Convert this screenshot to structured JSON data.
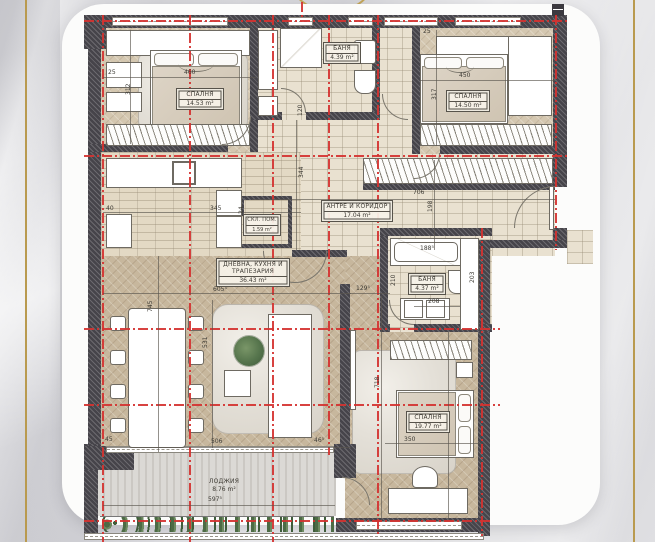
{
  "plan": {
    "title": "apartment-floor-plan",
    "colors": {
      "axis_red": "#d43230",
      "gold_trim": "#b99a4f",
      "wall": "#46444a",
      "wood_floor": "#c7b79d",
      "tile_floor": "#e9e1d0"
    },
    "rooms": [
      {
        "id": "bedroom-1",
        "name": "СПАЛНЯ",
        "area": "14.53 m²"
      },
      {
        "id": "bath-1",
        "name": "БАНЯ",
        "area": "4.39 m²"
      },
      {
        "id": "bedroom-2",
        "name": "СПАЛНЯ",
        "area": "14.50 m²"
      },
      {
        "id": "hall",
        "name": "АНТРЕ И КОРИДОР",
        "area": "17.04 m²"
      },
      {
        "id": "storage",
        "name": "СКЛ. ПОМ.",
        "area": "1.59 m²"
      },
      {
        "id": "living",
        "name": "ДНЕВНА, КУХНЯ И ТРАПЕЗАРИЯ",
        "area": "36.43 m²"
      },
      {
        "id": "bath-2",
        "name": "БАНЯ",
        "area": "4.37 m²"
      },
      {
        "id": "bedroom-3",
        "name": "СПАЛНЯ",
        "area": "19.77 m²"
      },
      {
        "id": "loggia",
        "name": "ЛОДЖИЯ",
        "area": "8.76 m²"
      }
    ],
    "dims": [
      {
        "t": "460"
      },
      {
        "t": "312"
      },
      {
        "t": "25"
      },
      {
        "t": "450"
      },
      {
        "t": "317"
      },
      {
        "t": "25"
      },
      {
        "t": "344"
      },
      {
        "t": "706"
      },
      {
        "t": "198"
      },
      {
        "t": "40"
      },
      {
        "t": "345"
      },
      {
        "t": "24"
      },
      {
        "t": "745"
      },
      {
        "t": "605⁵"
      },
      {
        "t": "531"
      },
      {
        "t": "506"
      },
      {
        "t": "46⁵"
      },
      {
        "t": "45"
      },
      {
        "t": "129⁵"
      },
      {
        "t": "718"
      },
      {
        "t": "188⁵"
      },
      {
        "t": "208"
      },
      {
        "t": "203"
      },
      {
        "t": "475"
      },
      {
        "t": "350"
      },
      {
        "t": "597⁵"
      },
      {
        "t": "210"
      },
      {
        "t": "120"
      }
    ]
  }
}
